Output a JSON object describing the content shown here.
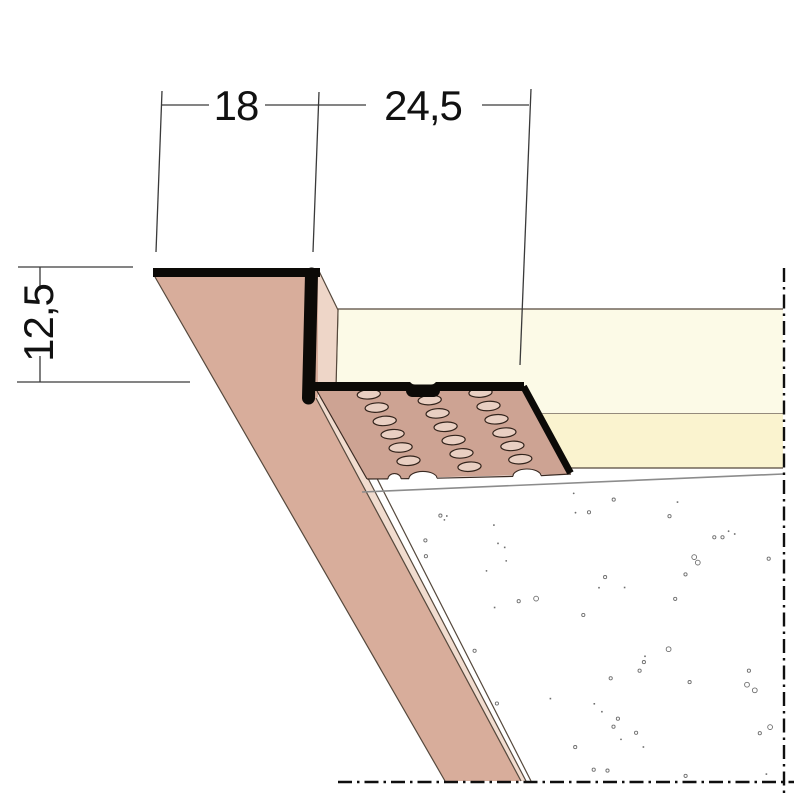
{
  "drawing": {
    "kind": "plasterboard-edge-profile-section",
    "dimension_labels": {
      "top_flange_width": "18",
      "perforated_flange_width": "24,5",
      "board_thickness": "12,5"
    },
    "colors": {
      "profile_black": "#0c0a07",
      "profile_face": "#d8ad9b",
      "profile_face_light": "#eed6c8",
      "strip_light": "#f1dccf",
      "perforated_flange": "#cda393",
      "hole_fill": "#e9cfc2",
      "hole_stroke": "#32231b",
      "board_section": "#fcfae7",
      "board_surface": "#faf3cf",
      "notch_fill": "#ffffff",
      "plaster_line": "#8c8c8c",
      "stipple": "#6e6e6e",
      "dim_color": "#111111"
    },
    "perforation": {
      "origin": [
        317,
        391.5
      ],
      "u": [
        207,
        -3
      ],
      "v": [
        52,
        87
      ],
      "col_fractions": [
        0.24,
        0.515,
        0.78
      ],
      "rows": 6,
      "row_start": 0.04,
      "row_pitch": 0.153,
      "stagger_mid_col": 0.077,
      "rx": 11.6,
      "ry": 4.7,
      "rotation": -4
    },
    "stipple_field": {
      "count": 58,
      "seed": 987631,
      "x_min": 352,
      "x_max": 776,
      "y_min": 466,
      "y_max": 776,
      "topline_x": 362,
      "topline_y": 493,
      "topline_slope": -0.0435,
      "leftline_x": 318,
      "leftline_y": 395,
      "leftline_dxdy": 0.531
    },
    "dash_dot_pattern": "14 5 2.5 5"
  }
}
